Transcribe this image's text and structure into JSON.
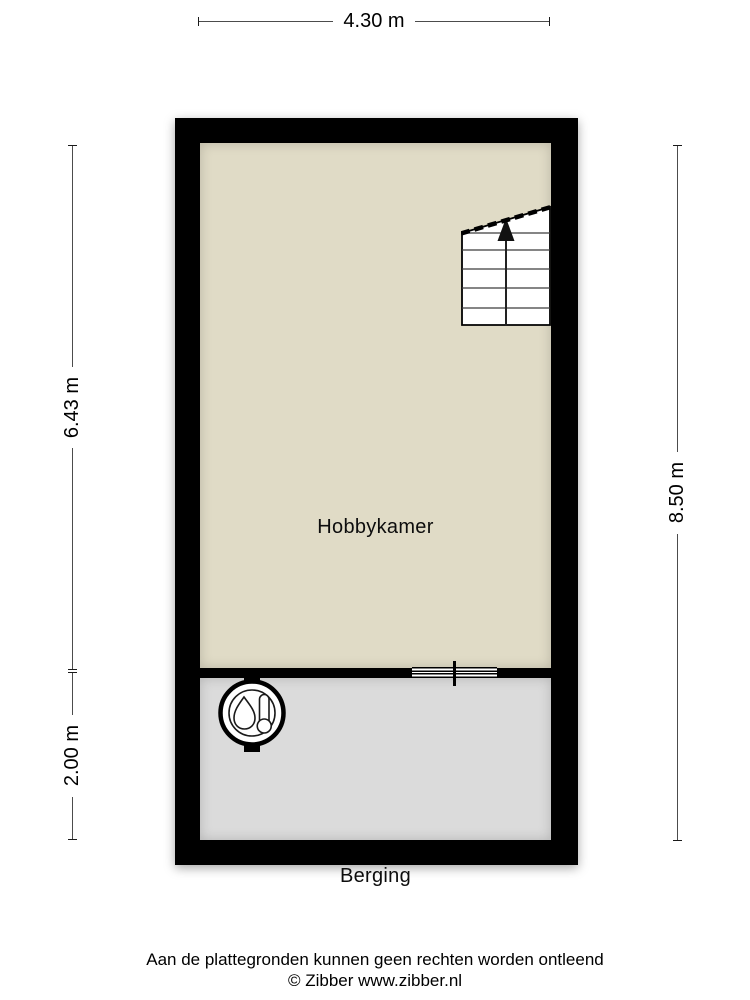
{
  "floorplan": {
    "rooms": [
      {
        "name": "Hobbykamer",
        "floor_color": "#e0dbc6"
      },
      {
        "name": "Berging",
        "floor_color": "#dbdbdb"
      }
    ],
    "dimensions": {
      "top_width": "4.30 m",
      "left_upper": "6.43 m",
      "left_lower": "2.00 m",
      "right_total": "8.50 m"
    },
    "colors": {
      "wall": "#000000",
      "dimension_line": "#4c4c4c",
      "stairs_fill": "#ffffff"
    },
    "icons": [
      "boiler-icon",
      "stairs-up-arrow-icon",
      "interior-window-symbol"
    ],
    "stairs_direction": "up"
  },
  "footer": {
    "disclaimer": "Aan de plattegronden kunnen geen rechten worden ontleend",
    "copyright": "© Zibber www.zibber.nl"
  }
}
